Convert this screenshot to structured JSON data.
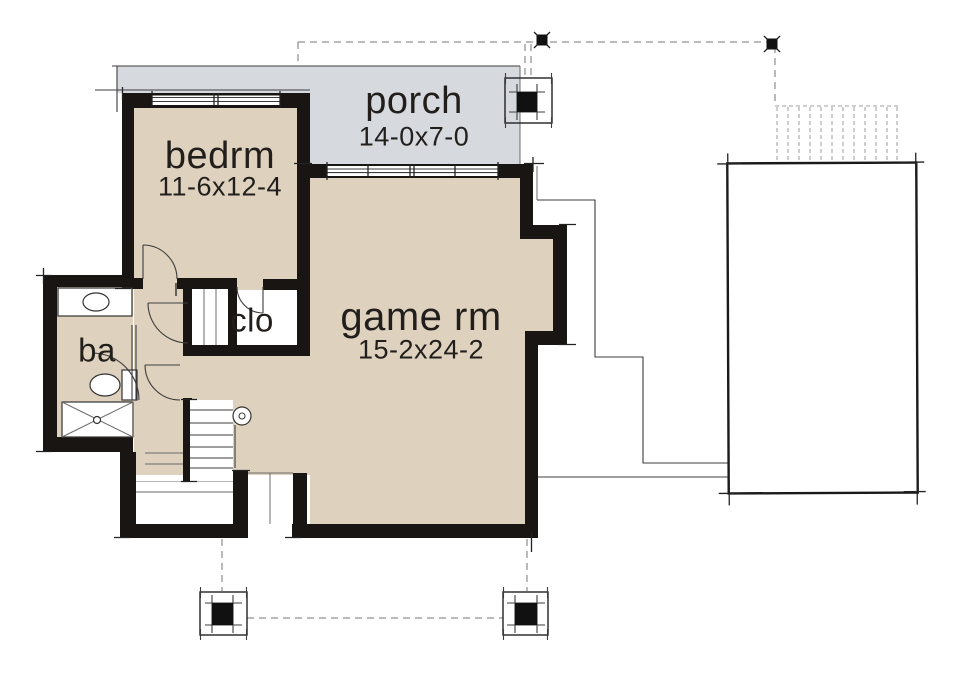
{
  "page": {
    "background": "#ffffff",
    "type": "architectural floor plan (basement level)"
  },
  "colors": {
    "floor": "#ded2bf",
    "porch": "#d6d9de",
    "wall": "#181512",
    "line": "#3d3d3d",
    "dash": "#949494",
    "text": "#221e1b"
  },
  "rooms": {
    "porch": {
      "label": "porch",
      "dims": "14-0x7-0"
    },
    "bedroom": {
      "label": "bedrm",
      "dims": "11-6x12-4"
    },
    "game_room": {
      "label": "game rm",
      "dims": "15-2x24-2"
    },
    "closet": {
      "label": "clo"
    },
    "bath": {
      "label": "ba"
    }
  }
}
